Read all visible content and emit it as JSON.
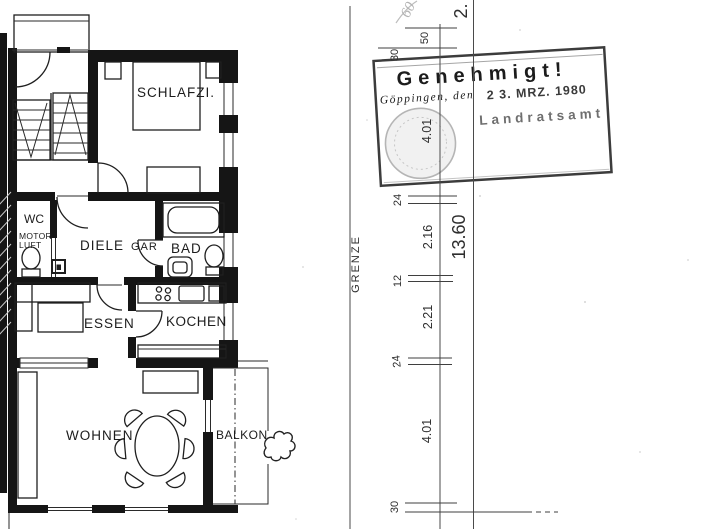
{
  "document": {
    "kind": "scanned approved building floor plan",
    "background": "#ffffff",
    "ink_color": "#1f1f1f"
  },
  "plan": {
    "rooms": {
      "schlafzimmer": "SCHLAFZI.",
      "wc": "WC",
      "wc_note1": "MOTOR",
      "wc_note2": "LUFT",
      "diele": "DIELE",
      "diele_note": "GAR",
      "bad": "BAD",
      "essen": "ESSEN",
      "kochen": "KOCHEN",
      "wohnen": "WOHNEN",
      "balkon": "BALKON"
    }
  },
  "survey": {
    "boundary_label": "GRENZE",
    "handwritten_mark": "60",
    "partial_dim_top": "2.",
    "dim_50": "50",
    "dim_30_top": "30",
    "dim_401_top": "4.01",
    "dim_24_a": "24",
    "dim_216": "2.16",
    "total_length": "13.60",
    "dim_12": "12",
    "dim_221": "2.21",
    "dim_24_b": "24",
    "dim_401_bottom": "4.01",
    "dim_30_bottom": "30"
  },
  "stamp": {
    "title": "Genehmigt!",
    "place": "Göppingen, den",
    "date": "2 3. MRZ. 1980",
    "authority": "Landratsamt",
    "border_color": "#3c3c3c",
    "ink_color": "#2b2b2b",
    "faded_color": "#9d9d9d"
  }
}
